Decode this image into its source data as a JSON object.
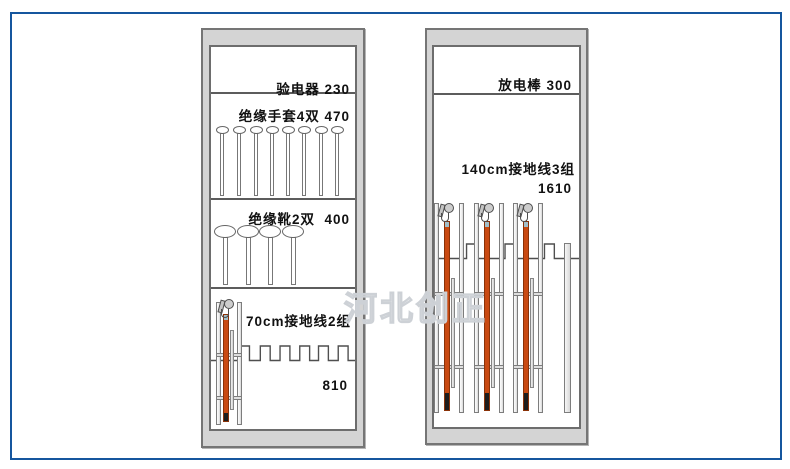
{
  "watermark": {
    "text": "河北创正"
  },
  "left_cabinet": {
    "section1_label": "验电器 230",
    "section2_label": "绝缘手套4双 470",
    "section3_label": "绝缘靴2双  400",
    "section4_label": "70cm接地线2组",
    "section4_value": "810",
    "glove_hanger_count": 8,
    "boot_hanger_count": 4,
    "ground_wire_assembly_count": 1
  },
  "right_cabinet": {
    "section1_label": "放电棒 300",
    "section2_label": "140cm接地线3组",
    "section2_value": "1610",
    "ground_wire_assembly_count": 3
  },
  "colors": {
    "page_border": "#15569e",
    "cabinet_fill": "#d4d4d4",
    "cabinet_border": "#757575",
    "panel_fill": "#ffffff",
    "divider": "#5c5c5c",
    "rod_orange": "#c94a12",
    "rod_tip": "#1d1d1d",
    "rod_ferrule": "#a3bfc9",
    "watermark_stroke": "#cdd1d6"
  }
}
